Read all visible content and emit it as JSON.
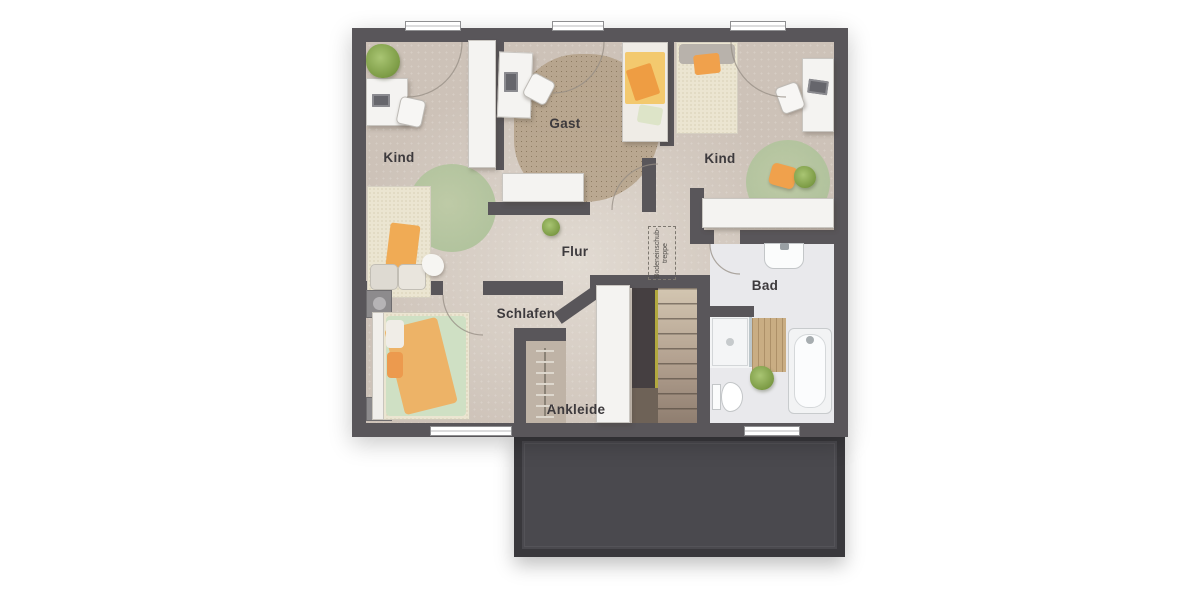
{
  "rooms": {
    "kind_left": {
      "label": "Kind"
    },
    "gast": {
      "label": "Gast"
    },
    "kind_right": {
      "label": "Kind"
    },
    "flur": {
      "label": "Flur"
    },
    "schlafen": {
      "label": "Schlafen"
    },
    "ankleide": {
      "label": "Ankleide"
    },
    "bad": {
      "label": "Bad"
    },
    "attic_hatch": {
      "line1": "Bodeneinschub-",
      "line2": "treppe"
    }
  },
  "colors": {
    "wall": "#59565a",
    "floor": "#cdc2b8",
    "bath_floor": "#e9e9ec",
    "roof": "#4a494e",
    "accent_orange": "#f0a14c",
    "accent_green": "#b7c79c",
    "wood": "#c9ad83"
  }
}
